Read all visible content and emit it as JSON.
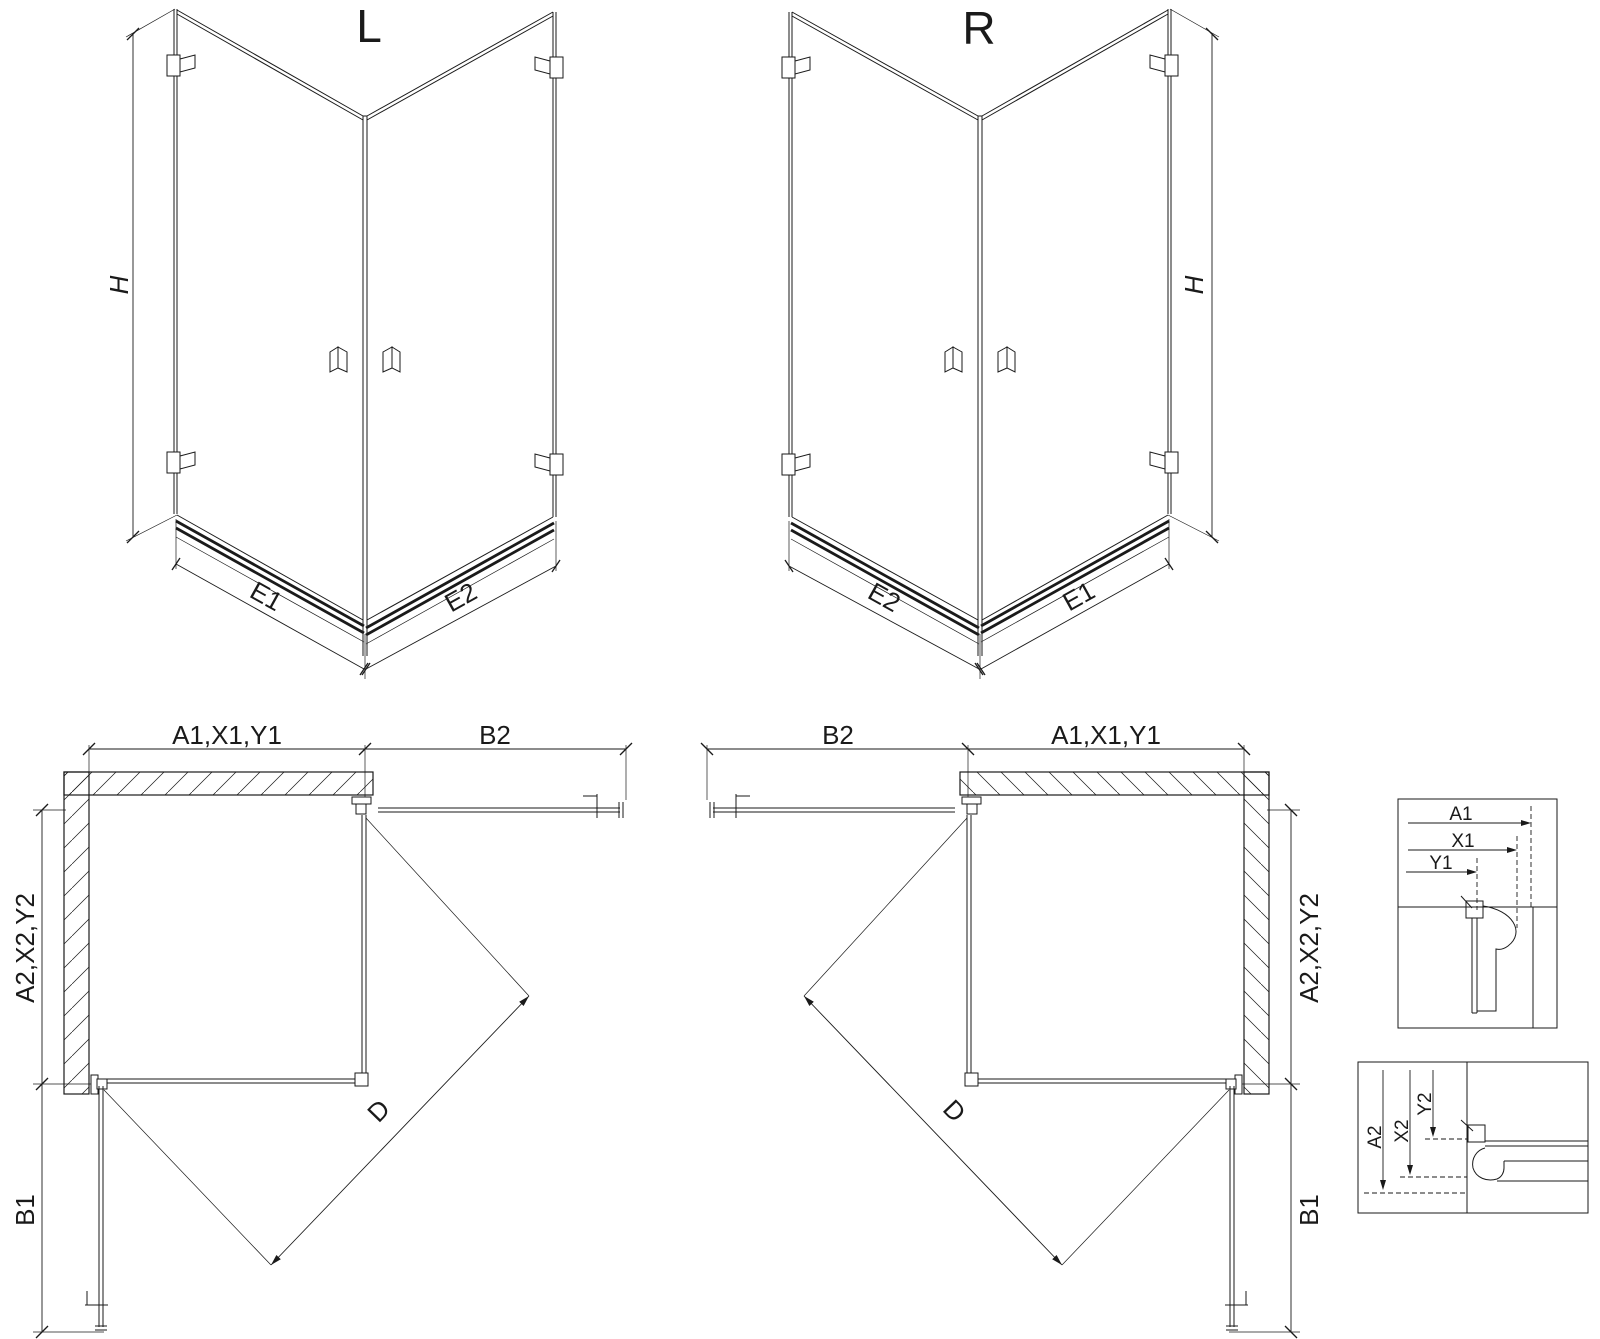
{
  "page": {
    "background_color": "#ffffff",
    "line_color": "#1a1a1a"
  },
  "views": {
    "iso_left": {
      "label": "L",
      "dim_height": "H",
      "dim_bottom_left": "E1",
      "dim_bottom_right": "E2"
    },
    "iso_right": {
      "label": "R",
      "dim_height": "H",
      "dim_bottom_left": "E2",
      "dim_bottom_right": "E1"
    },
    "plan_left": {
      "dim_top_left": "A1,X1,Y1",
      "dim_top_right": "B2",
      "dim_side": "A2,X2,Y2",
      "dim_door_side": "B1",
      "dim_diagonal": "D"
    },
    "plan_right": {
      "dim_top_left": "B2",
      "dim_top_right": "A1,X1,Y1",
      "dim_side": "A2,X2,Y2",
      "dim_door_side": "B1",
      "dim_diagonal": "D"
    },
    "detail_top": {
      "dim_a": "A1",
      "dim_x": "X1",
      "dim_y": "Y1"
    },
    "detail_bottom": {
      "dim_a": "A2",
      "dim_x": "X2",
      "dim_y": "Y2"
    }
  }
}
